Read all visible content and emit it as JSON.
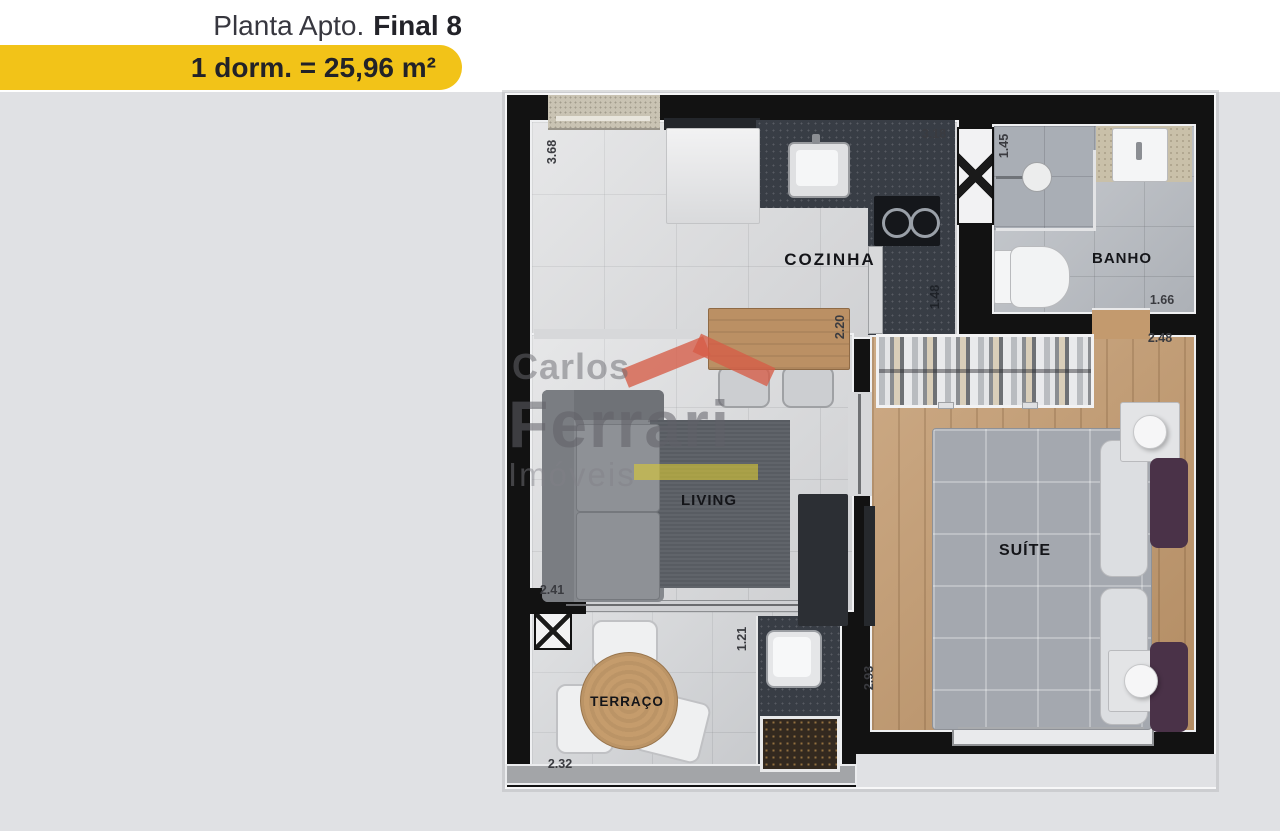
{
  "header": {
    "title": {
      "regular": "Planta Apto.",
      "bold": "Final 8"
    },
    "subtitle": "1 dorm. = 25,96 m²",
    "pill_color": "#f2c318"
  },
  "watermark": {
    "word1": "Carlos",
    "word2": "Ferrari",
    "word3": "Imóveis"
  },
  "plan": {
    "rooms": {
      "kitchen": "COZINHA",
      "bath": "BANHO",
      "living": "LIVING",
      "suite": "SUÍTE",
      "terrace": "TERRAÇO"
    },
    "dimensions": {
      "left_wall": "3.68",
      "kitchen_top": "3.18",
      "bath_width": "1.45",
      "bath_bottom": "1.66",
      "suite_top": "2.48",
      "kitchen_counter": "2.20",
      "counter_side": "1.48",
      "living_width": "2.41",
      "terrace_depth": "1.21",
      "suite_side": "2.93",
      "terrace_width": "2.32"
    }
  }
}
